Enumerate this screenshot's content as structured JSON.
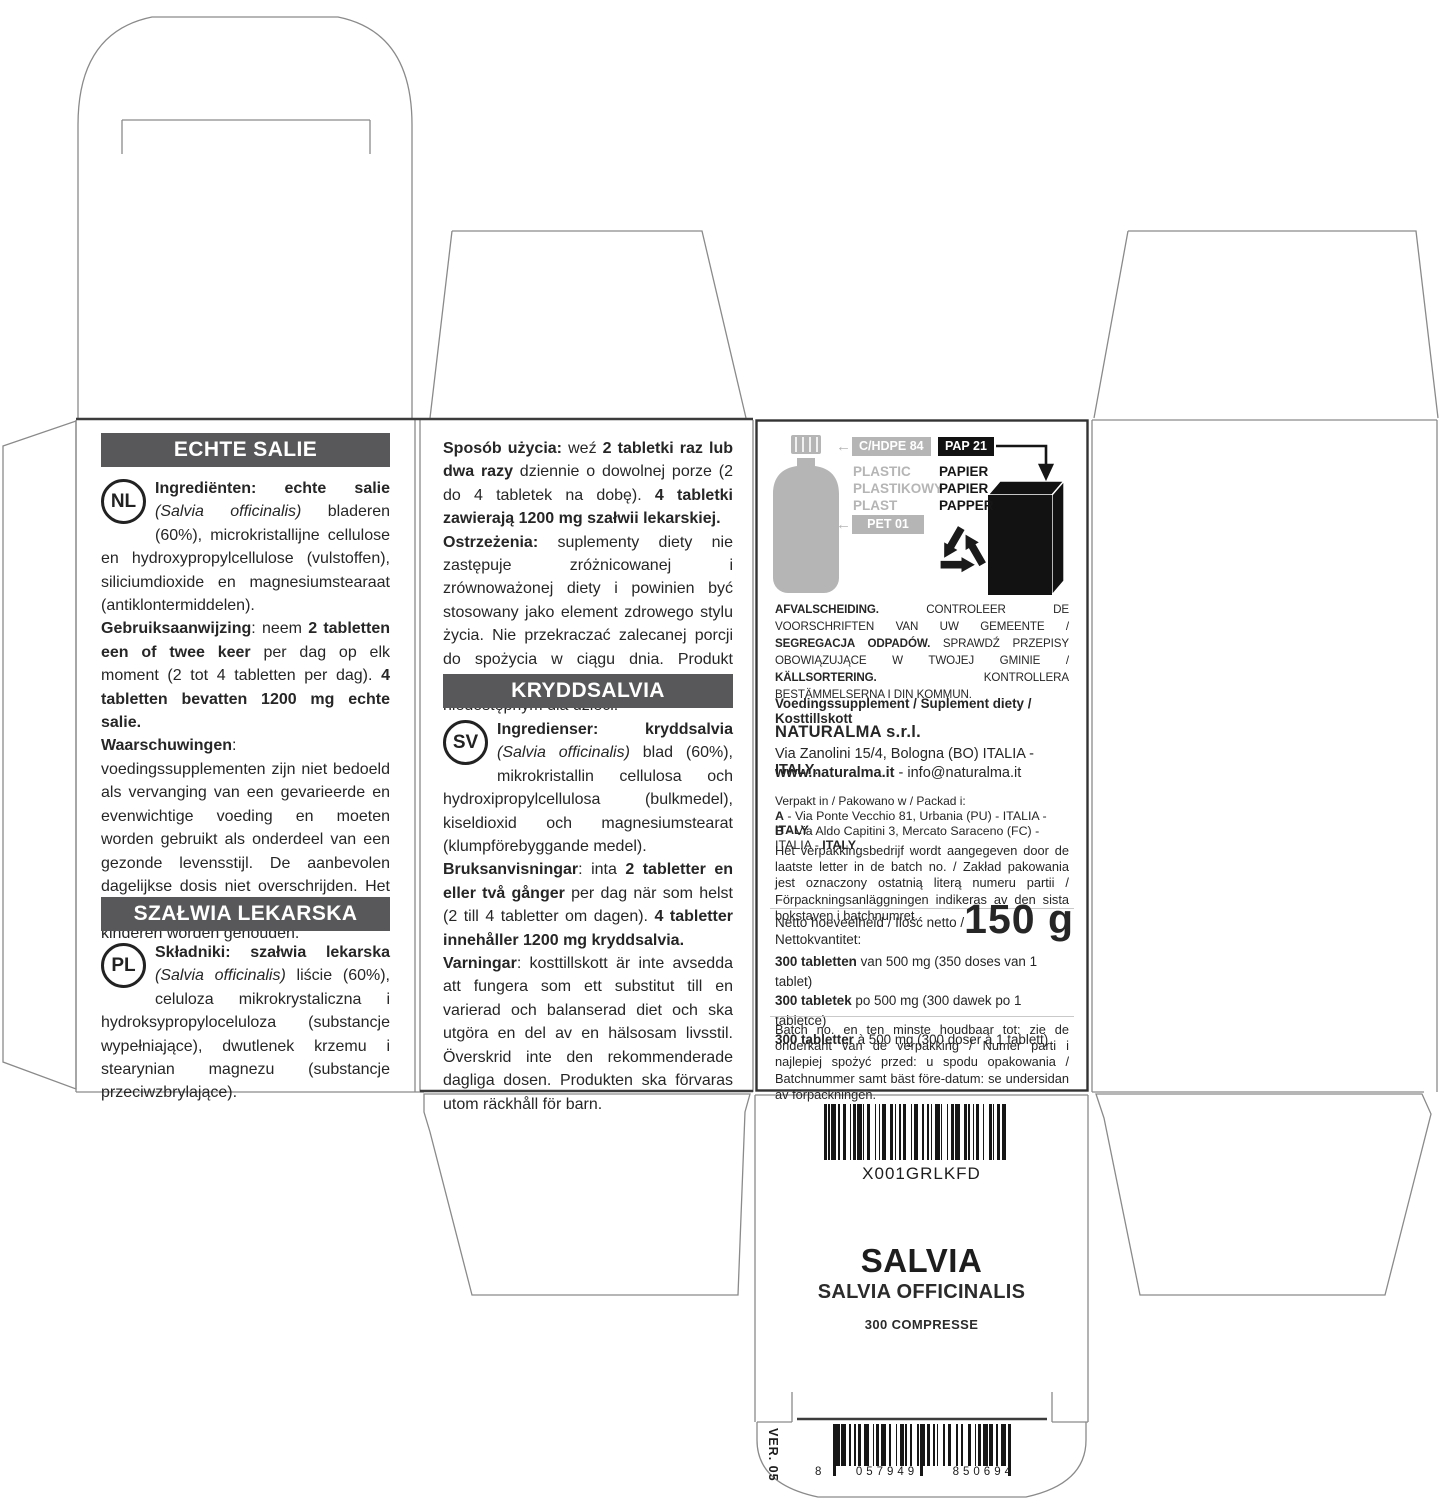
{
  "colors": {
    "header_bar": "#58585a",
    "ink": "#262626",
    "icon_gray": "#b5b5b5",
    "icon_black": "#121212",
    "outline": "#8a8a8a"
  },
  "icons": {
    "left_arrow": "←"
  },
  "back1": {
    "header_nl": "ECHTE SALIE",
    "badge_nl": "NL",
    "nl_p1": [
      [
        "b",
        "Ingrediënten: echte salie "
      ],
      [
        "i",
        "(Salvia officinalis)"
      ],
      [
        "r",
        " bladeren (60%), microkristallijne cellulose en hydroxypropylcellulose (vulstoffen), siliciumdioxide en magnesiumstearaat (antiklontermiddelen)."
      ]
    ],
    "nl_p2": [
      [
        "b",
        "Gebruiksaanwijzing"
      ],
      [
        "r",
        ": neem "
      ],
      [
        "b",
        "2 tabletten een of twee keer "
      ],
      [
        "r",
        "per dag op elk moment (2 tot 4 tabletten per dag). "
      ],
      [
        "b",
        "4 tabletten bevatten 1200 mg echte salie."
      ]
    ],
    "nl_p3": [
      [
        "b",
        "Waarschuwingen"
      ],
      [
        "r",
        ": voedingssupplementen zijn niet bedoeld als vervanging van een gevarieerde en evenwichtige voeding en moeten worden gebruikt als onderdeel van een gezonde levensstijl. De aanbevolen dagelijkse dosis niet overschrijden. Het product moet buiten het bereik van kinderen worden gehouden."
      ]
    ],
    "header_pl": "SZAŁWIA LEKARSKA",
    "badge_pl": "PL",
    "pl_p1": [
      [
        "b",
        "Składniki: szałwia lekarska "
      ],
      [
        "i",
        "(Salvia officinalis)"
      ],
      [
        "r",
        " liście (60%), celuloza mikrokrystaliczna i hydroksypropyloceluloza (substancje wypełniające), dwutlenek krzemu i stearynian magnezu (substancje przeciwzbrylające)."
      ]
    ]
  },
  "back2": {
    "pl_usage": [
      [
        "b",
        "Sposób użycia: "
      ],
      [
        "r",
        "weź "
      ],
      [
        "b",
        "2 tabletki raz lub dwa razy "
      ],
      [
        "r",
        "dziennie o dowolnej porze (2 do 4 tabletek na dobę). "
      ],
      [
        "b",
        "4 tabletki zawierają 1200 mg szałwii lekarskiej."
      ]
    ],
    "pl_warn": [
      [
        "b",
        "Ostrzeżenia: "
      ],
      [
        "r",
        "suplementy diety nie zastępuje zróżnicowanej i zrównoważonej diety i powinien być stosowany jako element zdrowego stylu życia. Nie przekraczać zalecanej porcji do spożycia w ciągu dnia. Produkt należy przechowywać w miejscu niedostępnym dla dzieci."
      ]
    ],
    "header_sv": "KRYDDSALVIA",
    "badge_sv": "SV",
    "sv_p1": [
      [
        "b",
        "Ingredienser: kryddsalvia "
      ],
      [
        "i",
        "(Salvia officinalis)"
      ],
      [
        "r",
        " blad (60%), mikrokristallin cellulosa och hydroxipropylcellulosa (bulkmedel), kiseldioxid och magnesiumstearat (klumpförebyggande medel)."
      ]
    ],
    "sv_p2": [
      [
        "b",
        "Bruksanvisningar"
      ],
      [
        "r",
        ": inta "
      ],
      [
        "b",
        "2 tabletter en eller två gånger "
      ],
      [
        "r",
        "per dag när som helst (2 till 4 tabletter om dagen). "
      ],
      [
        "b",
        "4 tabletter innehåller 1200 mg kryddsalvia."
      ]
    ],
    "sv_p3": [
      [
        "b",
        "Varningar"
      ],
      [
        "r",
        ": kosttillskott är inte avsedda att fungera som ett substitut till en varierad och balanserad diet och ska utgöra en del av en hälsosam livsstil. Överskrid inte den rekommenderade dagliga dosen. Produkten ska förvaras utom räckhåll för barn."
      ]
    ]
  },
  "info": {
    "plastic_code": "C/HDPE 84",
    "plastic_words": {
      "l1": "PLASTIC",
      "l2": "PLASTIKOWY",
      "l3": "PLAST"
    },
    "pet_code": "PET 01",
    "paper_code": "PAP 21",
    "paper_words": {
      "l1": "PAPIER",
      "l2": "PAPIER",
      "l3": "PAPPER"
    },
    "disposal": [
      [
        "b",
        "AFVALSCHEIDING. "
      ],
      [
        "r",
        "CONTROLEER DE VOORSCHRIFTEN VAN UW GEMEENTE / "
      ],
      [
        "b",
        "SEGREGACJA ODPADÓW. "
      ],
      [
        "r",
        "SPRAWDŹ PRZEPISY OBOWIĄZUJĄCE W TWOJEJ GMINIE / "
      ],
      [
        "b",
        "KÄLLSORTERING. "
      ],
      [
        "r",
        "KONTROLLERA BESTÄMMELSERNA I DIN KOMMUN."
      ]
    ],
    "supplement_line": "Voedingssupplement / Suplement diety / Kosttillskott",
    "company": "NATURALMA s.r.l.",
    "address": [
      [
        "r",
        "Via Zanolini 15/4, Bologna (BO) ITALIA - "
      ],
      [
        "b",
        "ITALY"
      ],
      [
        "r",
        "."
      ]
    ],
    "web": [
      [
        "b",
        "www.naturalma.it"
      ],
      [
        "r",
        " - info@naturalma.it"
      ]
    ],
    "packed_intro": "Verpakt in / Pakowano w / Packad i:",
    "packed_a": [
      [
        "b",
        "A"
      ],
      [
        "r",
        " - Via Ponte Vecchio 81, Urbania (PU) - ITALIA - "
      ],
      [
        "b",
        "ITALY"
      ],
      [
        "r",
        "."
      ]
    ],
    "packed_b": [
      [
        "b",
        "B"
      ],
      [
        "r",
        " - Via Aldo Capitini 3, Mercato Saraceno (FC) - ITALIA - "
      ],
      [
        "b",
        "ITALY"
      ],
      [
        "r",
        "."
      ]
    ],
    "packer_note": "Het verpakkingsbedrijf wordt aangegeven door de laatste letter in de batch no. / Zakład pakowania jest oznaczony ostatnią literą numeru partii / Förpackningsanläggningen indikeras av den sista bokstaven i batchnumret.",
    "net_label": "Netto hoeveelheid / Ilość netto /\nNettokvantitet:",
    "net_value": "150 g",
    "count1": [
      [
        "b",
        "300 tabletten "
      ],
      [
        "r",
        "van 500 mg (350 doses van 1 tablet)"
      ]
    ],
    "count2": [
      [
        "b",
        "300 tabletek "
      ],
      [
        "r",
        "po 500 mg (300 dawek po 1 tabletce)"
      ]
    ],
    "count3": [
      [
        "b",
        "300 tabletter "
      ],
      [
        "r",
        "à 500 mg (300 doser à 1 tablett)"
      ]
    ],
    "batch_note": "Batch no. en ten minste houdbaar tot: zie de onderkant van de verpakking / Numer parti i najlepiej spożyć przed: u spodu opakowania / Batchnummer samt bäst före-datum: se undersidan av förpackningen."
  },
  "front": {
    "sku": "X001GRLKFD",
    "title": "SALVIA",
    "subtitle": "SALVIA OFFICINALIS",
    "count": "300 COMPRESSE"
  },
  "bottom": {
    "version": "VER. 05",
    "ean_g1": "8",
    "ean_g2": "057949",
    "ean_g3": "850694"
  }
}
